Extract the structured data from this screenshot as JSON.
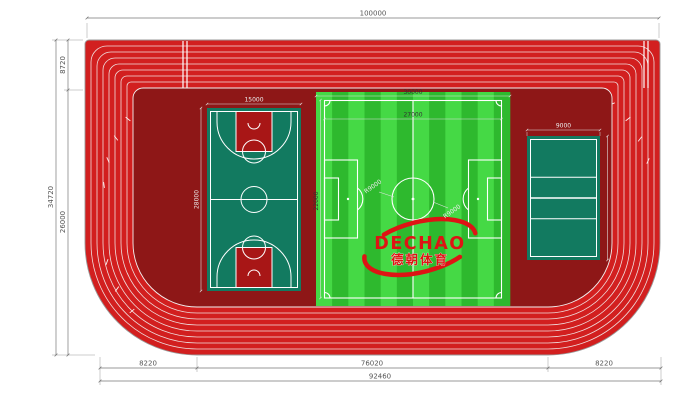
{
  "annotations": {
    "overall_width": "100000",
    "total_height": "34720",
    "band_height": "8720",
    "loop_height": "26000",
    "bottom_left_segment": "8220",
    "bottom_middle_segment": "76020",
    "bottom_right_segment": "8220",
    "bottom_total": "92460",
    "basketball_width": "15000",
    "basketball_length": "28000",
    "football_outer_width": "30000",
    "football_inner_width": "27000",
    "football_length": "22000",
    "football_radius_left": "R9000",
    "football_radius_right": "R9000",
    "volleyball_width": "9000"
  },
  "logo": {
    "brand": "DECHAO",
    "chinese": "德朝体育"
  },
  "colors": {
    "track_red": "#D21F1F",
    "apron_maroon": "#8E1717",
    "court_teal": "#127A60",
    "basketball_key_red": "#A81616",
    "grass_light": "#45D945",
    "grass_dark": "#2EB92E",
    "line_white": "#FFFFFF",
    "dimension_gray": "#777777",
    "logo_red": "#DE1414"
  }
}
